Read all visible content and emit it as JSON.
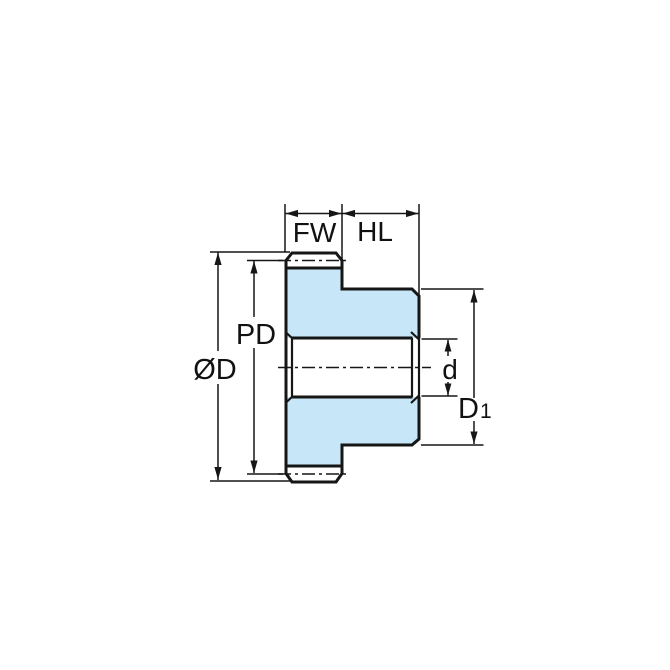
{
  "diagram": {
    "subject": "spur gear cross-section dimension drawing",
    "labels": {
      "face_width": "FW",
      "hub_length": "HL",
      "pitch_diameter": "PD",
      "outside_diameter": "ØD",
      "bore_diameter": "d",
      "hub_diameter_base": "D",
      "hub_diameter_subscript": "1"
    },
    "colors": {
      "part_fill": "#c7e6f7",
      "line": "#161616",
      "background": "#ffffff"
    }
  }
}
